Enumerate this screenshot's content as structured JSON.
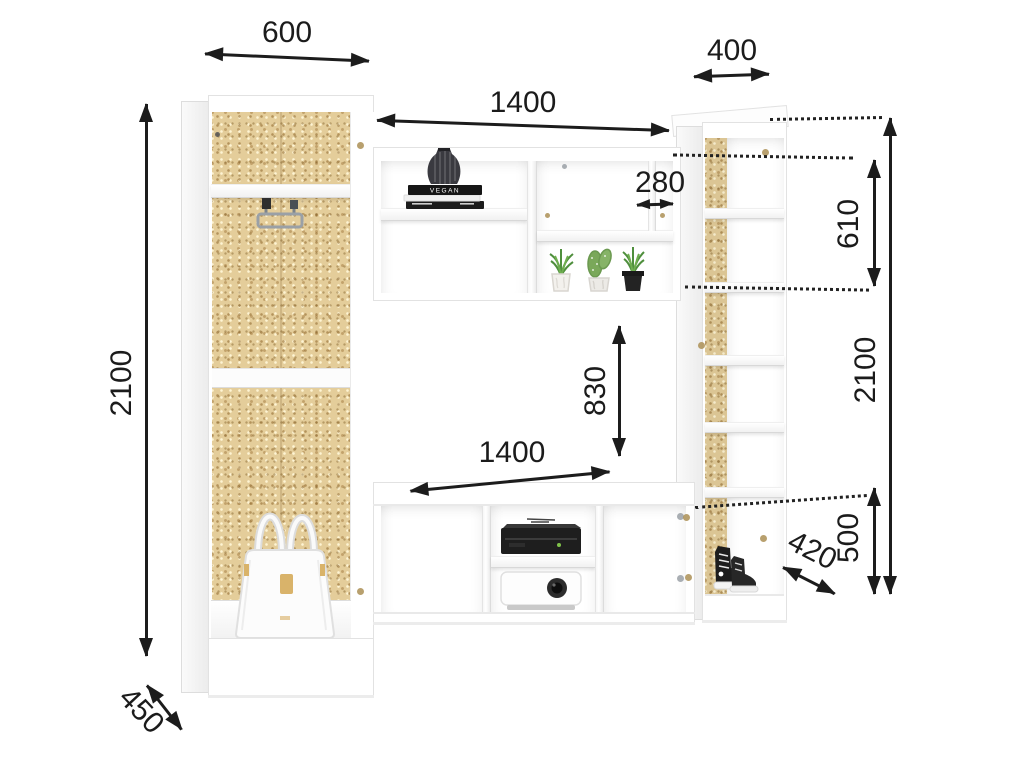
{
  "dims": {
    "left_width": "600",
    "top_width": "1400",
    "right_width": "400",
    "shelf_width": "280",
    "left_height": "2100",
    "left_depth": "450",
    "niche_height": "830",
    "niche_width": "1400",
    "right_top_section": "610",
    "right_height": "2100",
    "right_bottom_section": "500",
    "right_depth": "420"
  },
  "decor": {
    "book_spine": "VEGAN"
  },
  "colors": {
    "cork": "#e4cd9a",
    "dimension_line": "#1c1c1c",
    "panel": "#ffffff",
    "panel_edge": "#e2e2e2"
  }
}
